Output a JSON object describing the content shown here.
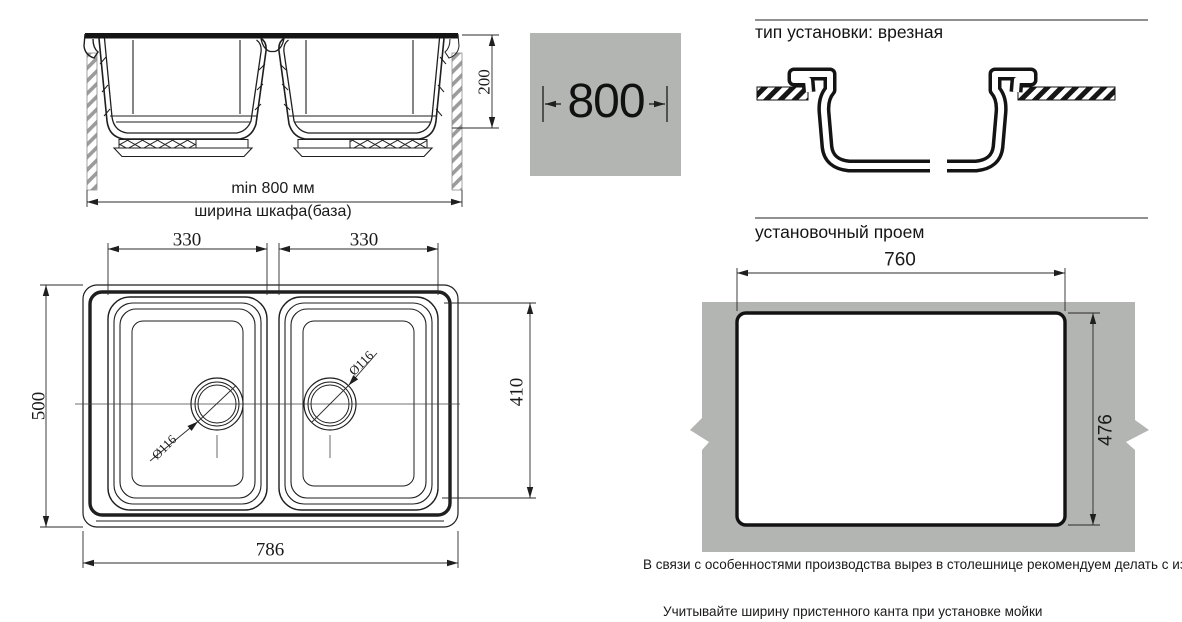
{
  "sheet": {
    "line_color": "#1f1f1f",
    "gray_fill": "#b3b5b2",
    "hatch_gray": "#9b9b9b"
  },
  "section_view": {
    "depth": "200",
    "min_width": "min 800 мм",
    "cabinet": "ширина шкафа(база)"
  },
  "size_box": {
    "width": "800"
  },
  "mount": {
    "title": "тип установки: врезная"
  },
  "top_view": {
    "left_bowl_width": "330",
    "right_bowl_width": "330",
    "overall_depth": "500",
    "bowls_depth": "410",
    "overall_width": "786",
    "left_drain": "Ø116",
    "right_drain": "Ø116"
  },
  "opening": {
    "title": "установочный проем",
    "width": "760",
    "depth": "476"
  },
  "notes": {
    "production": "В связи с особенностями производства вырез в столешнице рекомендуем делать с изделия.",
    "edge": "Учитывайте ширину пристенного канта при установке мойки"
  }
}
